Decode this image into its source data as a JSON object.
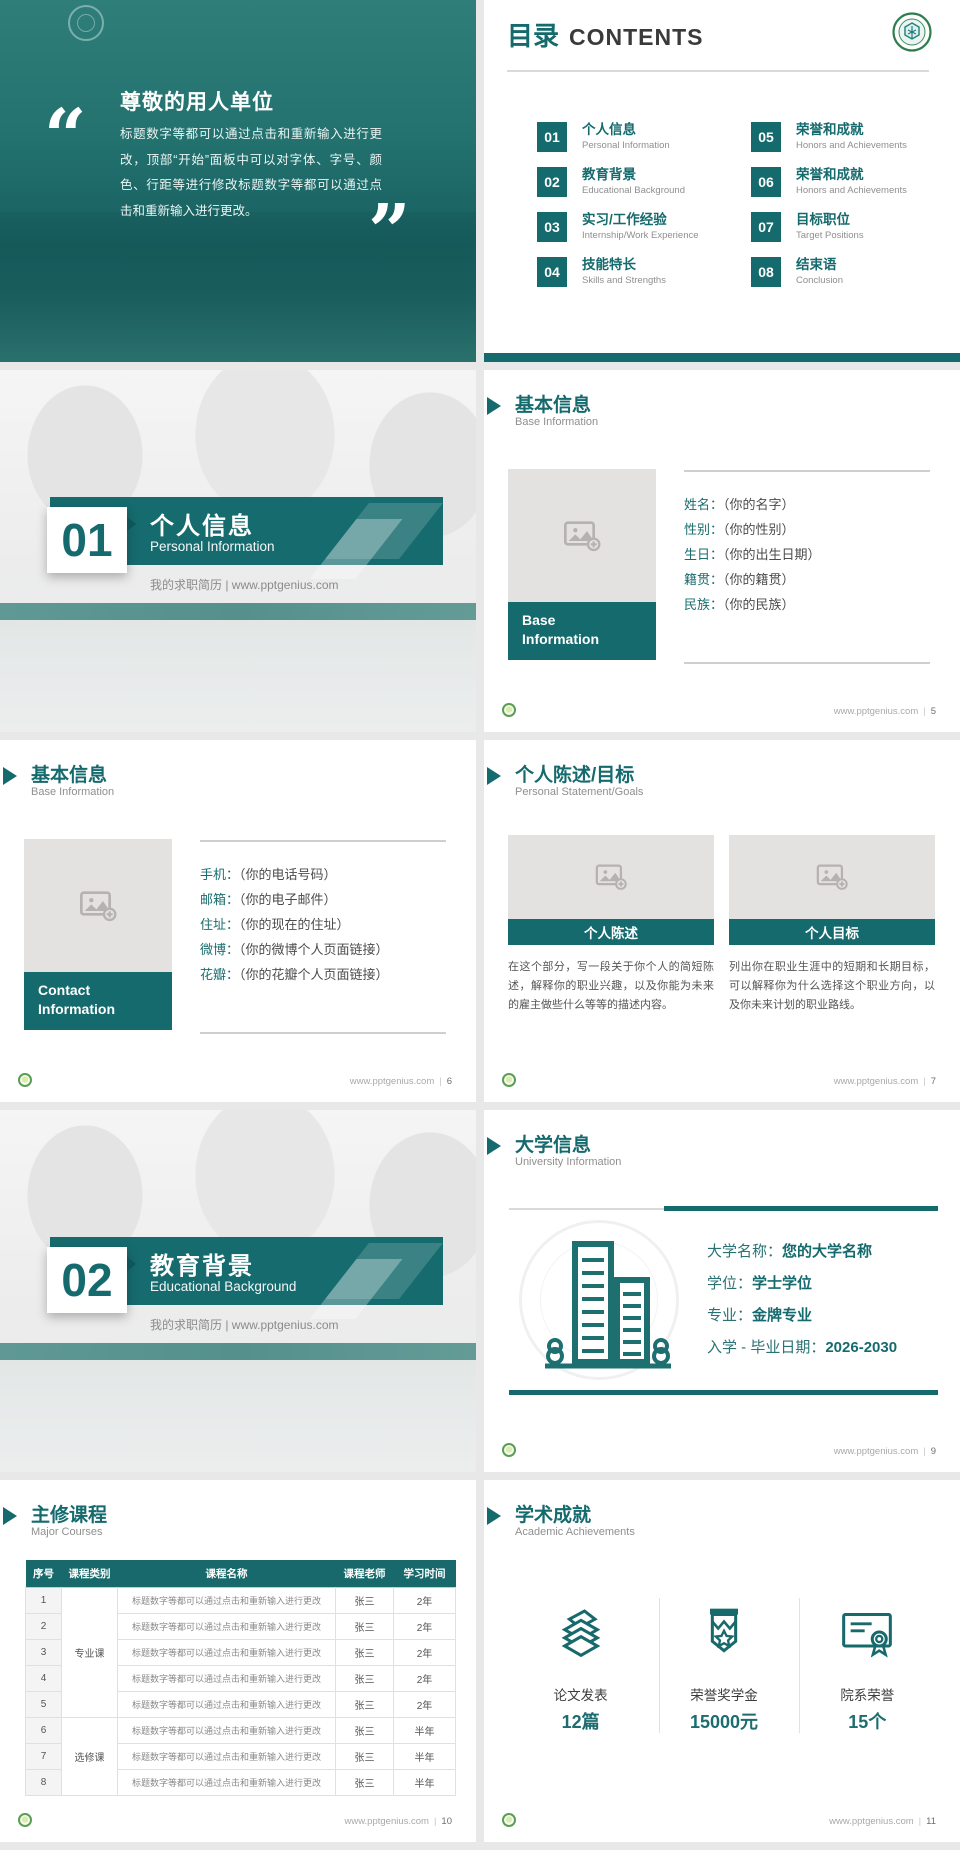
{
  "site": "www.pptgenius.com",
  "footer_sep": "|",
  "colors": {
    "teal": "#166b6e",
    "dark_text": "#3c3c3c",
    "subtitle_gray": "#8f8f8f",
    "placeholder_gray": "#e4e2e1"
  },
  "icons": {
    "placeholder": "image-add-icon",
    "title_pointer": "triangle-pointer-icon",
    "footer_logo": "pptgenius-logo",
    "toc_logo": "university-seal-icon",
    "university": "university-buildings-icon",
    "stat_icons": [
      "papers-icon",
      "medal-icon",
      "certificate-icon"
    ]
  },
  "cover": {
    "open_quote": "“",
    "close_quote": "”",
    "heading": "尊敬的用人单位",
    "body": "标题数字等都可以通过点击和重新输入进行更改，顶部“开始”面板中可以对字体、字号、颜色、行距等进行修改标题数字等都可以通过点击和重新输入进行更改。"
  },
  "toc": {
    "title_cn": "目录",
    "title_en": "CONTENTS",
    "items": [
      {
        "num": "01",
        "cn": "个人信息",
        "en": "Personal Information"
      },
      {
        "num": "02",
        "cn": "教育背景",
        "en": "Educational Background"
      },
      {
        "num": "03",
        "cn": "实习/工作经验",
        "en": "Internship/Work Experience"
      },
      {
        "num": "04",
        "cn": "技能特长",
        "en": "Skills and Strengths"
      },
      {
        "num": "05",
        "cn": "荣誉和成就",
        "en": "Honors and Achievements"
      },
      {
        "num": "06",
        "cn": "荣誉和成就",
        "en": "Honors and Achievements"
      },
      {
        "num": "07",
        "cn": "目标职位",
        "en": "Target Positions"
      },
      {
        "num": "08",
        "cn": "结束语",
        "en": "Conclusion"
      }
    ]
  },
  "section1": {
    "num": "01",
    "cn": "个人信息",
    "en": "Personal Information",
    "tagline": "我的求职简历 | www.pptgenius.com"
  },
  "section2": {
    "num": "02",
    "cn": "教育背景",
    "en": "Educational Background",
    "tagline": "我的求职简历 | www.pptgenius.com"
  },
  "base_info": {
    "title_cn": "基本信息",
    "title_en": "Base Information",
    "badge_line1": "Base",
    "badge_line2": "Information",
    "fields": [
      {
        "label": "姓名：",
        "value": "（你的名字）"
      },
      {
        "label": "性别：",
        "value": "（你的性别）"
      },
      {
        "label": "生日：",
        "value": "（你的出生日期）"
      },
      {
        "label": "籍贯：",
        "value": "（你的籍贯）"
      },
      {
        "label": "民族：",
        "value": "（你的民族）"
      }
    ],
    "page": "5"
  },
  "contact_info": {
    "title_cn": "基本信息",
    "title_en": "Base Information",
    "badge_line1": "Contact",
    "badge_line2": "Information",
    "fields": [
      {
        "label": "手机：",
        "value": "（你的电话号码）"
      },
      {
        "label": "邮箱：",
        "value": "（你的电子邮件）"
      },
      {
        "label": "住址：",
        "value": "（你的现在的住址）"
      },
      {
        "label": "微博：",
        "value": "（你的微博个人页面链接）"
      },
      {
        "label": "花瓣：",
        "value": "（你的花瓣个人页面链接）"
      }
    ],
    "page": "6"
  },
  "statement": {
    "title_cn": "个人陈述/目标",
    "title_en": "Personal Statement/Goals",
    "left_caption": "个人陈述",
    "left_text": "在这个部分，写一段关于你个人的简短陈述，解释你的职业兴趣，以及你能为未来的雇主做些什么等等的描述内容。",
    "right_caption": "个人目标",
    "right_text": "列出你在职业生涯中的短期和长期目标，可以解释你为什么选择这个职业方向，以及你未来计划的职业路线。",
    "page": "7"
  },
  "university": {
    "title_cn": "大学信息",
    "title_en": "University Information",
    "rows": [
      {
        "label": "大学名称：",
        "value": "您的大学名称"
      },
      {
        "label": "学位：",
        "value": "学士学位"
      },
      {
        "label": "专业：",
        "value": "金牌专业"
      },
      {
        "label": "入学 - 毕业日期：",
        "value": "2026-2030"
      }
    ],
    "page": "9"
  },
  "courses": {
    "title_cn": "主修课程",
    "title_en": "Major Courses",
    "headers": [
      "序号",
      "课程类别",
      "课程名称",
      "课程老师",
      "学习时间"
    ],
    "cat_a": "专业课",
    "cat_b": "选修课",
    "rows": [
      {
        "no": "1",
        "name": "标题数字等都可以通过点击和重新输入进行更改",
        "teacher": "张三",
        "time": "2年"
      },
      {
        "no": "2",
        "name": "标题数字等都可以通过点击和重新输入进行更改",
        "teacher": "张三",
        "time": "2年"
      },
      {
        "no": "3",
        "name": "标题数字等都可以通过点击和重新输入进行更改",
        "teacher": "张三",
        "time": "2年"
      },
      {
        "no": "4",
        "name": "标题数字等都可以通过点击和重新输入进行更改",
        "teacher": "张三",
        "time": "2年"
      },
      {
        "no": "5",
        "name": "标题数字等都可以通过点击和重新输入进行更改",
        "teacher": "张三",
        "time": "2年"
      },
      {
        "no": "6",
        "name": "标题数字等都可以通过点击和重新输入进行更改",
        "teacher": "张三",
        "time": "半年"
      },
      {
        "no": "7",
        "name": "标题数字等都可以通过点击和重新输入进行更改",
        "teacher": "张三",
        "time": "半年"
      },
      {
        "no": "8",
        "name": "标题数字等都可以通过点击和重新输入进行更改",
        "teacher": "张三",
        "time": "半年"
      }
    ],
    "page": "10"
  },
  "achievements": {
    "title_cn": "学术成就",
    "title_en": "Academic Achievements",
    "stats": [
      {
        "icon": "papers-icon",
        "label": "论文发表",
        "value": "12篇"
      },
      {
        "icon": "medal-icon",
        "label": "荣誉奖学金",
        "value": "15000元"
      },
      {
        "icon": "certificate-icon",
        "label": "院系荣誉",
        "value": "15个"
      }
    ],
    "page": "11"
  }
}
